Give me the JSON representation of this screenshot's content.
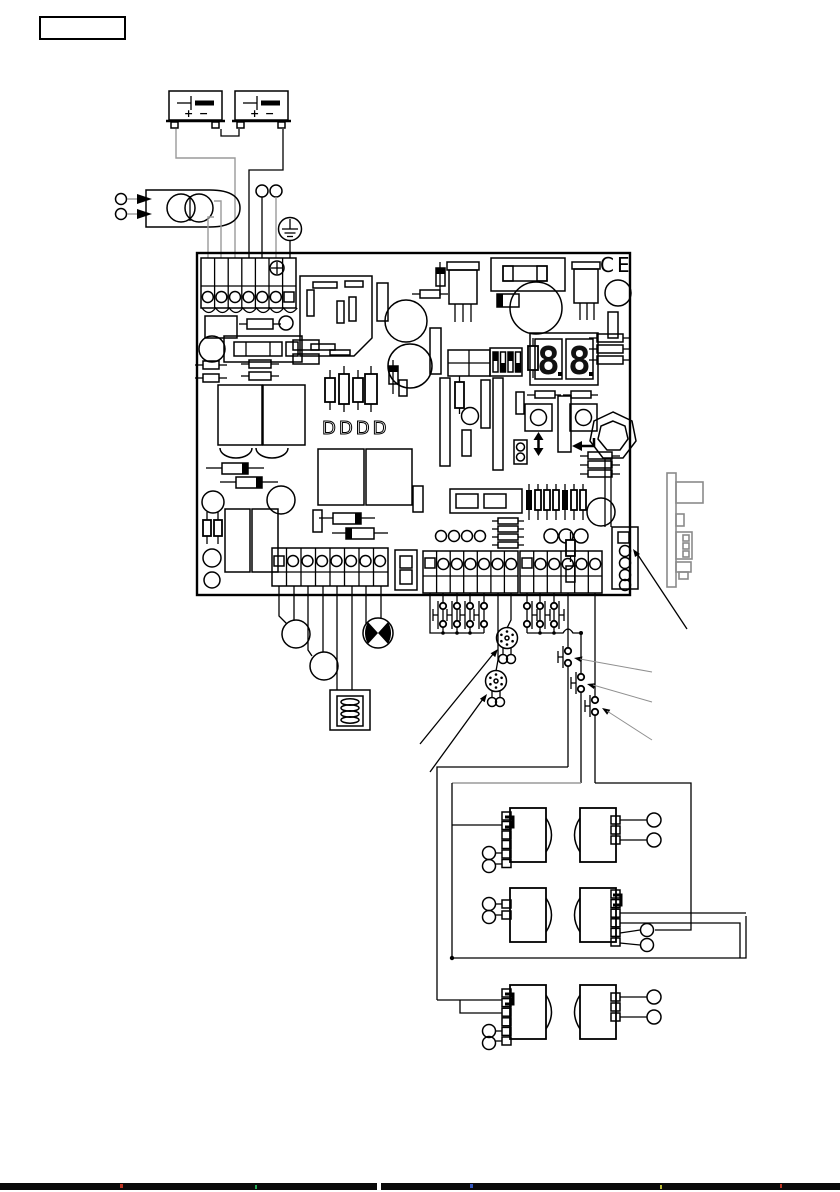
{
  "page": {
    "background": "#ffffff",
    "label_box_text": "",
    "width": 840,
    "height": 1192
  },
  "colors": {
    "ink": "#000000",
    "gray_wire": "#9a9a9a",
    "module_gray": "#8a8a8a",
    "bottom_bar": "#000000"
  },
  "battery": {
    "count": 2,
    "plus_label": "+",
    "minus_label": "−"
  },
  "board": {
    "ce_mark": "CE",
    "silkscreen_diodes": "DDDD",
    "display": {
      "value": "8.8.",
      "left_digit": "8",
      "right_digit": "8"
    },
    "terminal_blocks": {
      "top_power": 7,
      "bottom_left": 8,
      "bottom_middle": 7,
      "bottom_right": 6,
      "edge_connector": 5
    },
    "dip_switch_positions": 4,
    "leds": {
      "left_group": 4,
      "right_group": 3
    },
    "buttons": [
      {
        "id": "up-down",
        "icon": "up-down-arrow"
      },
      {
        "id": "enter",
        "icon": "enter-arrow"
      }
    ]
  },
  "external_devices": {
    "photocell_pairs": 3,
    "flashing_lamps": 2,
    "gearmotor": 1,
    "electric_lock": 1,
    "key_selectors": 2,
    "transformer": 1,
    "plug_in_receiver": 1
  }
}
